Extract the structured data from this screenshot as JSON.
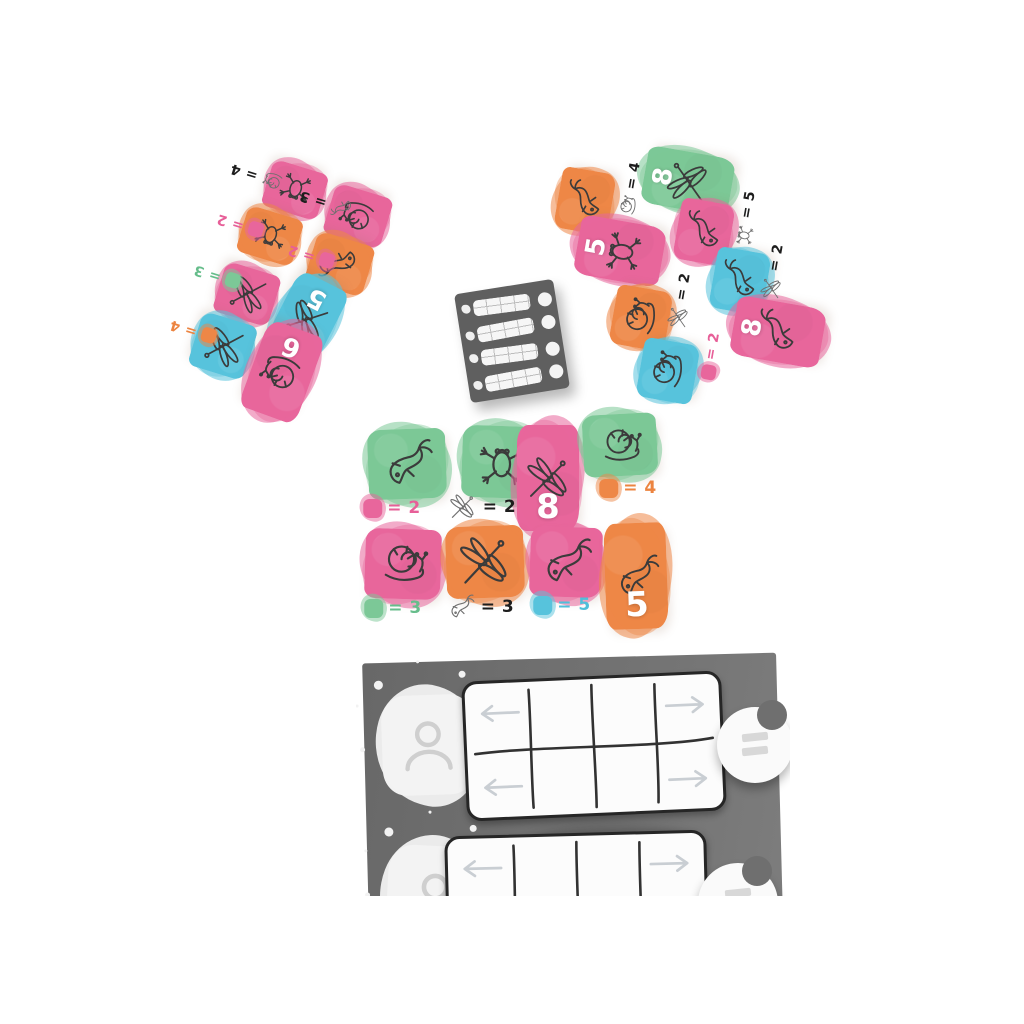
{
  "palette": {
    "pink": "#e8669c",
    "orange": "#ee8747",
    "teal": "#57c3dc",
    "green": "#7cc897",
    "card_ink": "#3b3b3b",
    "label_ink": "#1d1d1d",
    "board_gray": "#6f6f6f",
    "pad_gray": "#5f5f5f",
    "arrow_gray": "#c9ced3"
  },
  "left_fan": {
    "cards": [
      {
        "color": "pink",
        "animal": "frog"
      },
      {
        "color": "pink",
        "animal": "snail"
      },
      {
        "color": "orange",
        "animal": "frog"
      },
      {
        "color": "orange",
        "animal": "fish"
      },
      {
        "color": "pink",
        "animal": "dragonfly"
      },
      {
        "color": "teal",
        "animal": "dragonfly",
        "value": "5"
      },
      {
        "color": "teal",
        "animal": "dragonfly"
      },
      {
        "color": "pink",
        "animal": "snail",
        "value": "6"
      }
    ],
    "annotations": [
      {
        "icon": "snail",
        "label": "= 4",
        "label_color": "ink"
      },
      {
        "icon": "fish",
        "label": "= 3",
        "label_color": "ink"
      },
      {
        "swatch": "pink",
        "label": "= 2",
        "label_color": "pink"
      },
      {
        "swatch": "pink",
        "label": "= 2",
        "label_color": "pink"
      },
      {
        "swatch": "green",
        "label": "= 3",
        "label_color": "green"
      },
      {
        "swatch": "orange",
        "label": "= 4",
        "label_color": "orange"
      }
    ]
  },
  "right_fan": {
    "cards": [
      {
        "color": "green",
        "animal": "dragonfly",
        "value": "8"
      },
      {
        "color": "orange",
        "animal": "fish"
      },
      {
        "color": "pink",
        "animal": "frog",
        "value": "5"
      },
      {
        "color": "pink",
        "animal": "fish"
      },
      {
        "color": "teal",
        "animal": "fish"
      },
      {
        "color": "orange",
        "animal": "snail"
      },
      {
        "color": "pink",
        "animal": "fish",
        "value": "8"
      },
      {
        "color": "teal",
        "animal": "snail"
      }
    ],
    "annotations": [
      {
        "icon": "snail",
        "label": "= 4",
        "label_color": "ink"
      },
      {
        "icon": "frog",
        "label": "= 5",
        "label_color": "ink"
      },
      {
        "icon": "dragonfly",
        "label": "= 2",
        "label_color": "ink"
      },
      {
        "icon": "dragonfly",
        "label": "= 2",
        "label_color": "ink"
      },
      {
        "swatch": "pink",
        "label": "= 2",
        "label_color": "pink"
      }
    ]
  },
  "middle_spread": {
    "cards": [
      {
        "color": "green",
        "animal": "fish"
      },
      {
        "color": "green",
        "animal": "frog"
      },
      {
        "color": "pink",
        "animal": "dragonfly",
        "value": "8"
      },
      {
        "color": "green",
        "animal": "snail"
      },
      {
        "color": "pink",
        "animal": "snail"
      },
      {
        "color": "orange",
        "animal": "dragonfly"
      },
      {
        "color": "pink",
        "animal": "fish"
      },
      {
        "color": "orange",
        "animal": "fish",
        "value": "5"
      }
    ],
    "annotations": [
      {
        "swatch": "pink",
        "label": "= 2",
        "label_color": "pink"
      },
      {
        "icon": "dragonfly",
        "label": "= 2",
        "label_color": "ink"
      },
      {
        "swatch": "orange",
        "label": "= 4",
        "label_color": "orange"
      },
      {
        "swatch": "green",
        "label": "= 3",
        "label_color": "green"
      },
      {
        "icon": "fish",
        "label": "= 3",
        "label_color": "ink"
      },
      {
        "swatch": "teal",
        "label": "= 5",
        "label_color": "teal"
      }
    ]
  },
  "score_pad": {
    "rows": 4
  },
  "player_board": {
    "rows": 2,
    "token_symbol": "="
  }
}
